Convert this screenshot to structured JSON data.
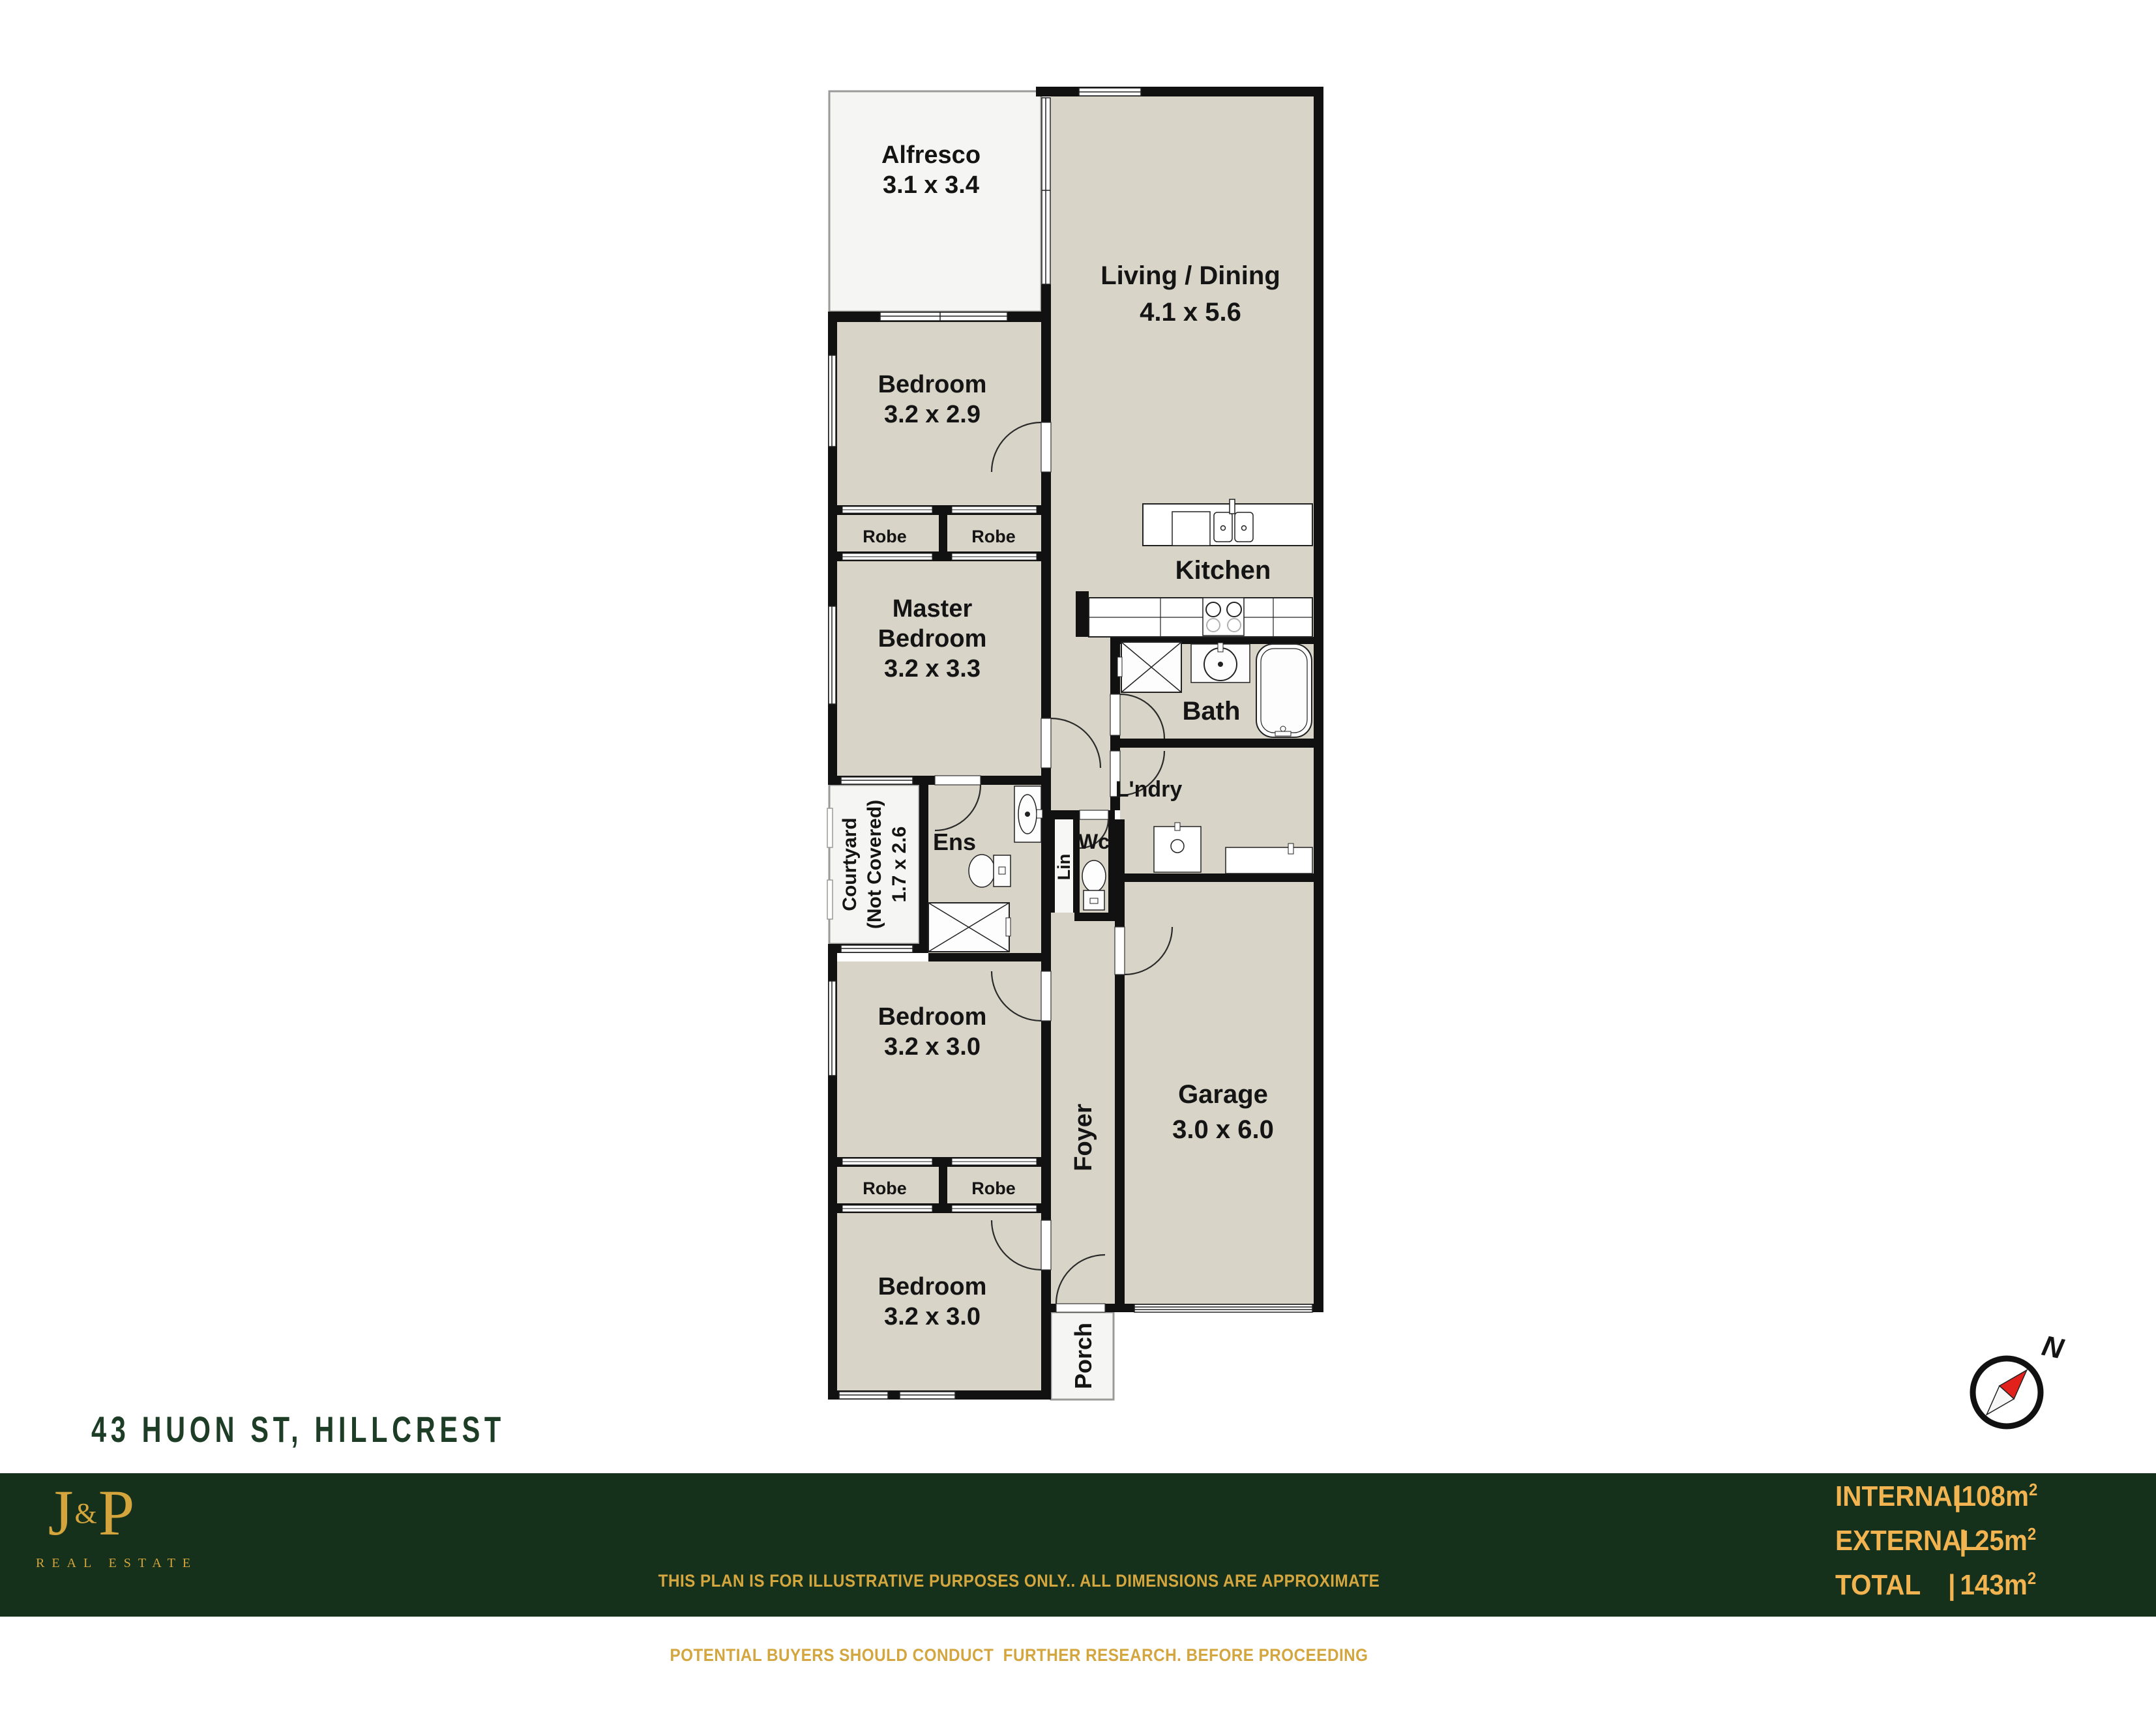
{
  "page_title": "43 HUON ST, HILLCREST",
  "plan": {
    "alfresco": {
      "name": "Alfresco",
      "dims": "3.1 x 3.4"
    },
    "living": {
      "name": "Living / Dining",
      "dims": "4.1 x 5.6"
    },
    "bedroom_top": {
      "name": "Bedroom",
      "dims": "3.2 x 2.9"
    },
    "robe_top_left": "Robe",
    "robe_top_right": "Robe",
    "master": {
      "name1": "Master",
      "name2": "Bedroom",
      "dims": "3.2 x 3.3"
    },
    "kitchen": "Kitchen",
    "bath": "Bath",
    "courtyard": {
      "name": "Courtyard",
      "note": "(Not Covered)",
      "dims": "1.7 x 2.6"
    },
    "ens": "Ens",
    "laundry": "L'ndry",
    "linen": "Lin",
    "wc": "Wc",
    "bedroom_mid": {
      "name": "Bedroom",
      "dims": "3.2 x 3.0"
    },
    "garage": {
      "name": "Garage",
      "dims": "3.0 x 6.0"
    },
    "robe_bottom_left": "Robe",
    "robe_bottom_right": "Robe",
    "bedroom_bottom": {
      "name": "Bedroom",
      "dims": "3.2 x 3.0"
    },
    "foyer": "Foyer",
    "porch": "Porch",
    "compass": "N"
  },
  "footer": {
    "logo_j": "J",
    "logo_amp": "&",
    "logo_p": "P",
    "logo_sub": "REAL ESTATE",
    "disclaimer_line1": "THIS PLAN IS FOR ILLUSTRATIVE PURPOSES ONLY.. ALL DIMENSIONS ARE APPROXIMATE",
    "disclaimer_line2": "POTENTIAL BUYERS SHOULD CONDUCT  FURTHER RESEARCH. BEFORE PROCEEDING",
    "areas": [
      {
        "label": "INTERNAL",
        "sep": "|",
        "value": "108m",
        "sup": "2"
      },
      {
        "label": "EXTERNAL",
        "sep": "|",
        "value": "25m",
        "sup": "2"
      },
      {
        "label": "TOTAL",
        "sep": "|",
        "value": "143m",
        "sup": "2"
      }
    ]
  },
  "colors": {
    "floor_beige": "#d8d4c7",
    "wall_black": "#111111",
    "footer_green": "#15301b",
    "title_green": "#1d3d26",
    "gold_bright": "#f2b451",
    "gold_muted": "#d4a63f",
    "compass_red": "#e2201c"
  }
}
